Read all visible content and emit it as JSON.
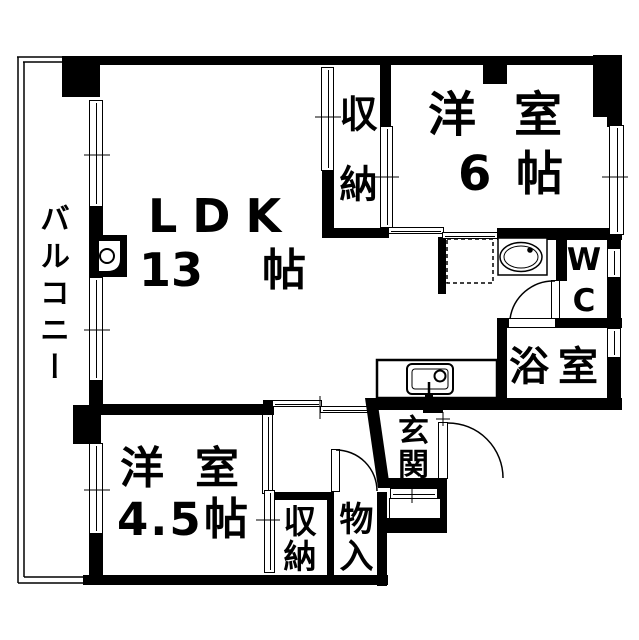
{
  "title": "マンション間取り図",
  "colors": {
    "wall": "#000000",
    "background": "#ffffff"
  },
  "rooms": {
    "balcony": {
      "label": "バルコニー"
    },
    "ldk": {
      "name": "LDK",
      "size_value": "13",
      "size_unit": "帖"
    },
    "closet_top": {
      "label": "収納"
    },
    "western_6": {
      "name": "洋室",
      "size_value": "6",
      "size_unit": "帖"
    },
    "wc": {
      "label": "WC"
    },
    "bath": {
      "label": "浴室"
    },
    "entrance": {
      "label": "玄関"
    },
    "western_45": {
      "name": "洋室",
      "size_value": "4.5",
      "size_unit": "帖"
    },
    "closet_bottom": {
      "label": "収納"
    },
    "storage": {
      "label": "物入"
    }
  }
}
